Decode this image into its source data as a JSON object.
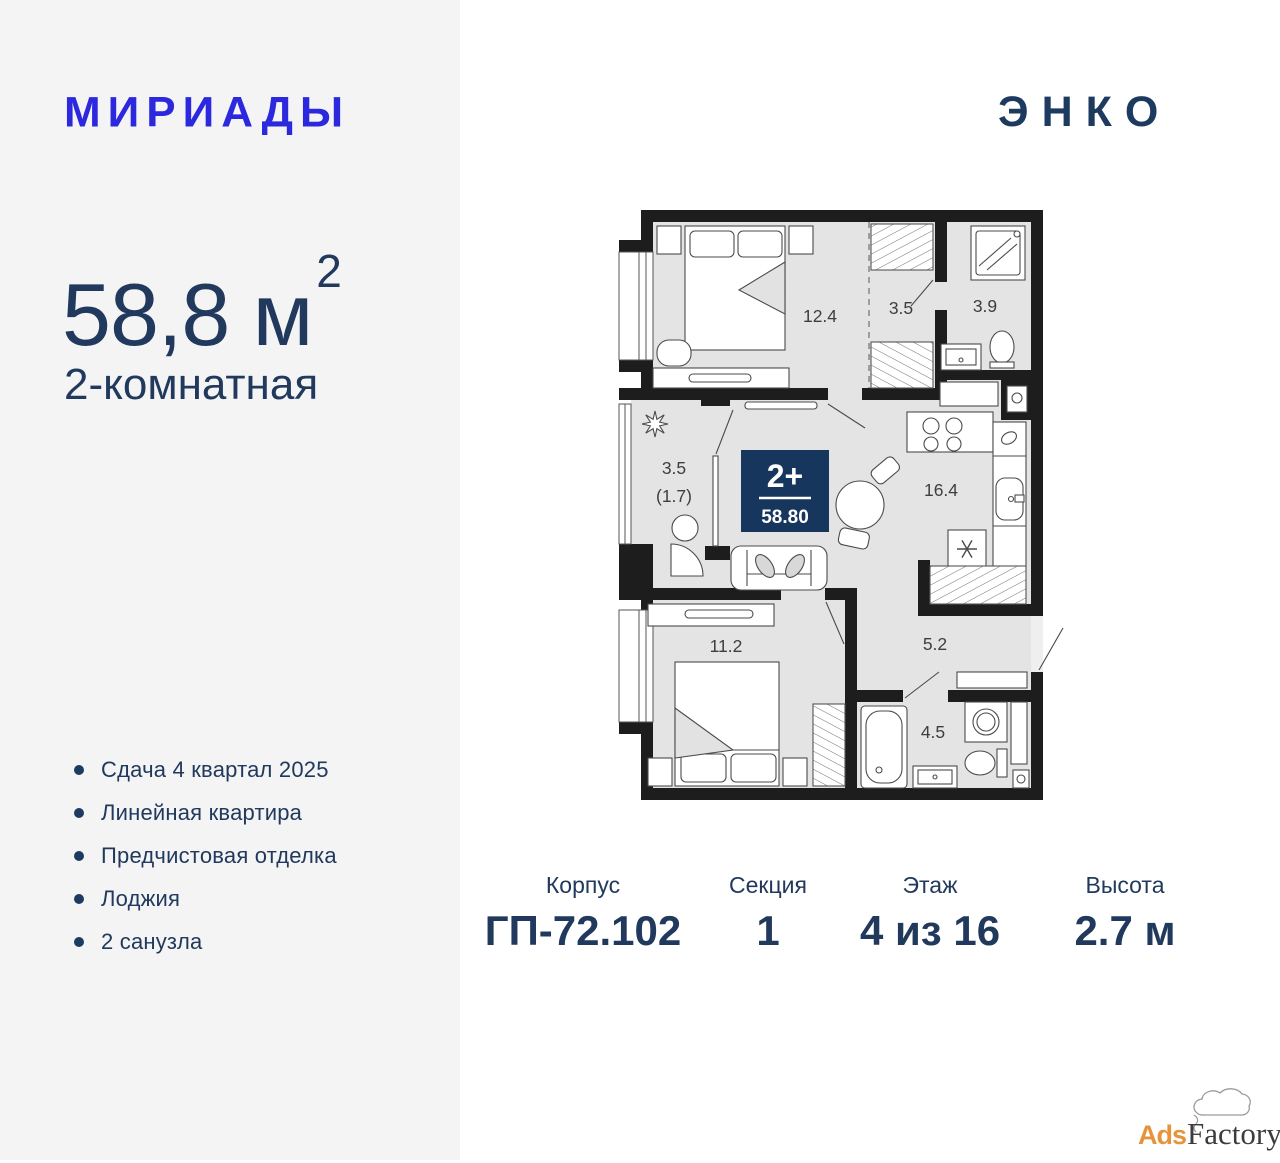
{
  "left_panel": {
    "brand": "МИРИАДЫ",
    "area_value": "58,8 м",
    "area_sup": "2",
    "apartment_type": "2-комнатная",
    "features": [
      "Сдача 4 квартал 2025",
      "Линейная квартира",
      "Предчистовая отделка",
      "Лоджия",
      "2 санузла"
    ]
  },
  "developer": {
    "logo": "ЭНКО"
  },
  "plan": {
    "badge": {
      "rooms": "2+",
      "area": "58.80"
    },
    "labels": {
      "bedroom1": "12.4",
      "wardrobe": "3.5",
      "bath1": "3.9",
      "kitchen": "16.4",
      "loggia": "3.5",
      "loggia_reduced": "(1.7)",
      "bedroom2": "11.2",
      "hall": "5.2",
      "bath2": "4.5"
    }
  },
  "details": [
    {
      "label": "Корпус",
      "value": "ГП-72.102"
    },
    {
      "label": "Секция",
      "value": "1"
    },
    {
      "label": "Этаж",
      "value": "4 из 16"
    },
    {
      "label": "Высота",
      "value": "2.7 м"
    }
  ],
  "watermark": {
    "part1": "Ads",
    "part2": "Factory"
  },
  "colors": {
    "brand_blue": "#2b28de",
    "navy_text": "#20395c",
    "badge_navy": "#17365e",
    "wall_black": "#1d1d1d",
    "floor_gray": "#e4e4e5",
    "left_bg": "#f4f4f5",
    "watermark_orange": "#e5943c"
  }
}
